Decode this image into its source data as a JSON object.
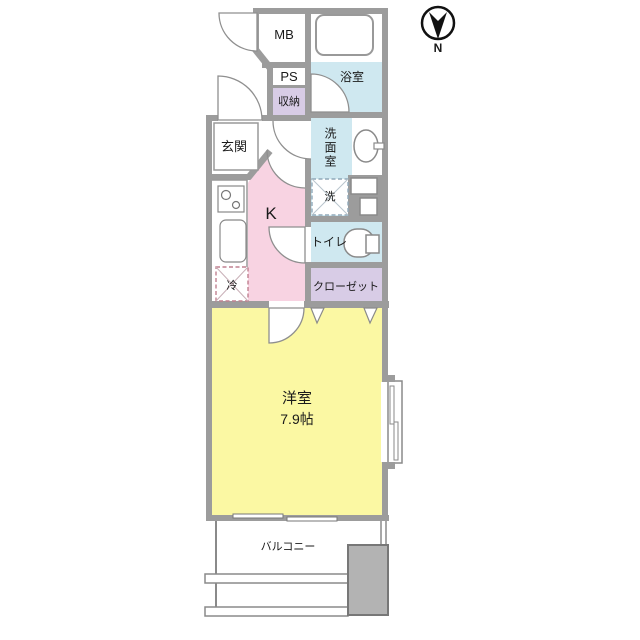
{
  "compass": {
    "north_label": "N"
  },
  "labels": {
    "mb": "MB",
    "ps": "PS",
    "storage": "収納",
    "bath": "浴室",
    "entrance": "玄関",
    "washroom": "洗面室",
    "washer": "洗",
    "kitchen": "K",
    "toilet": "トイレ",
    "closet": "クローゼット",
    "fridge": "冷",
    "main_room": "洋室",
    "main_room_size": "7.9帖",
    "balcony": "バルコニー"
  },
  "colors": {
    "wall": "#9c9c9c",
    "water_blue": "#cfe8f0",
    "storage_purple": "#d8cce6",
    "kitchen_pink": "#f8d3e2",
    "room_yellow": "#fbf8a3",
    "balcony_unit_gray": "#b3b3b3",
    "outline": "#8a8a8a"
  }
}
